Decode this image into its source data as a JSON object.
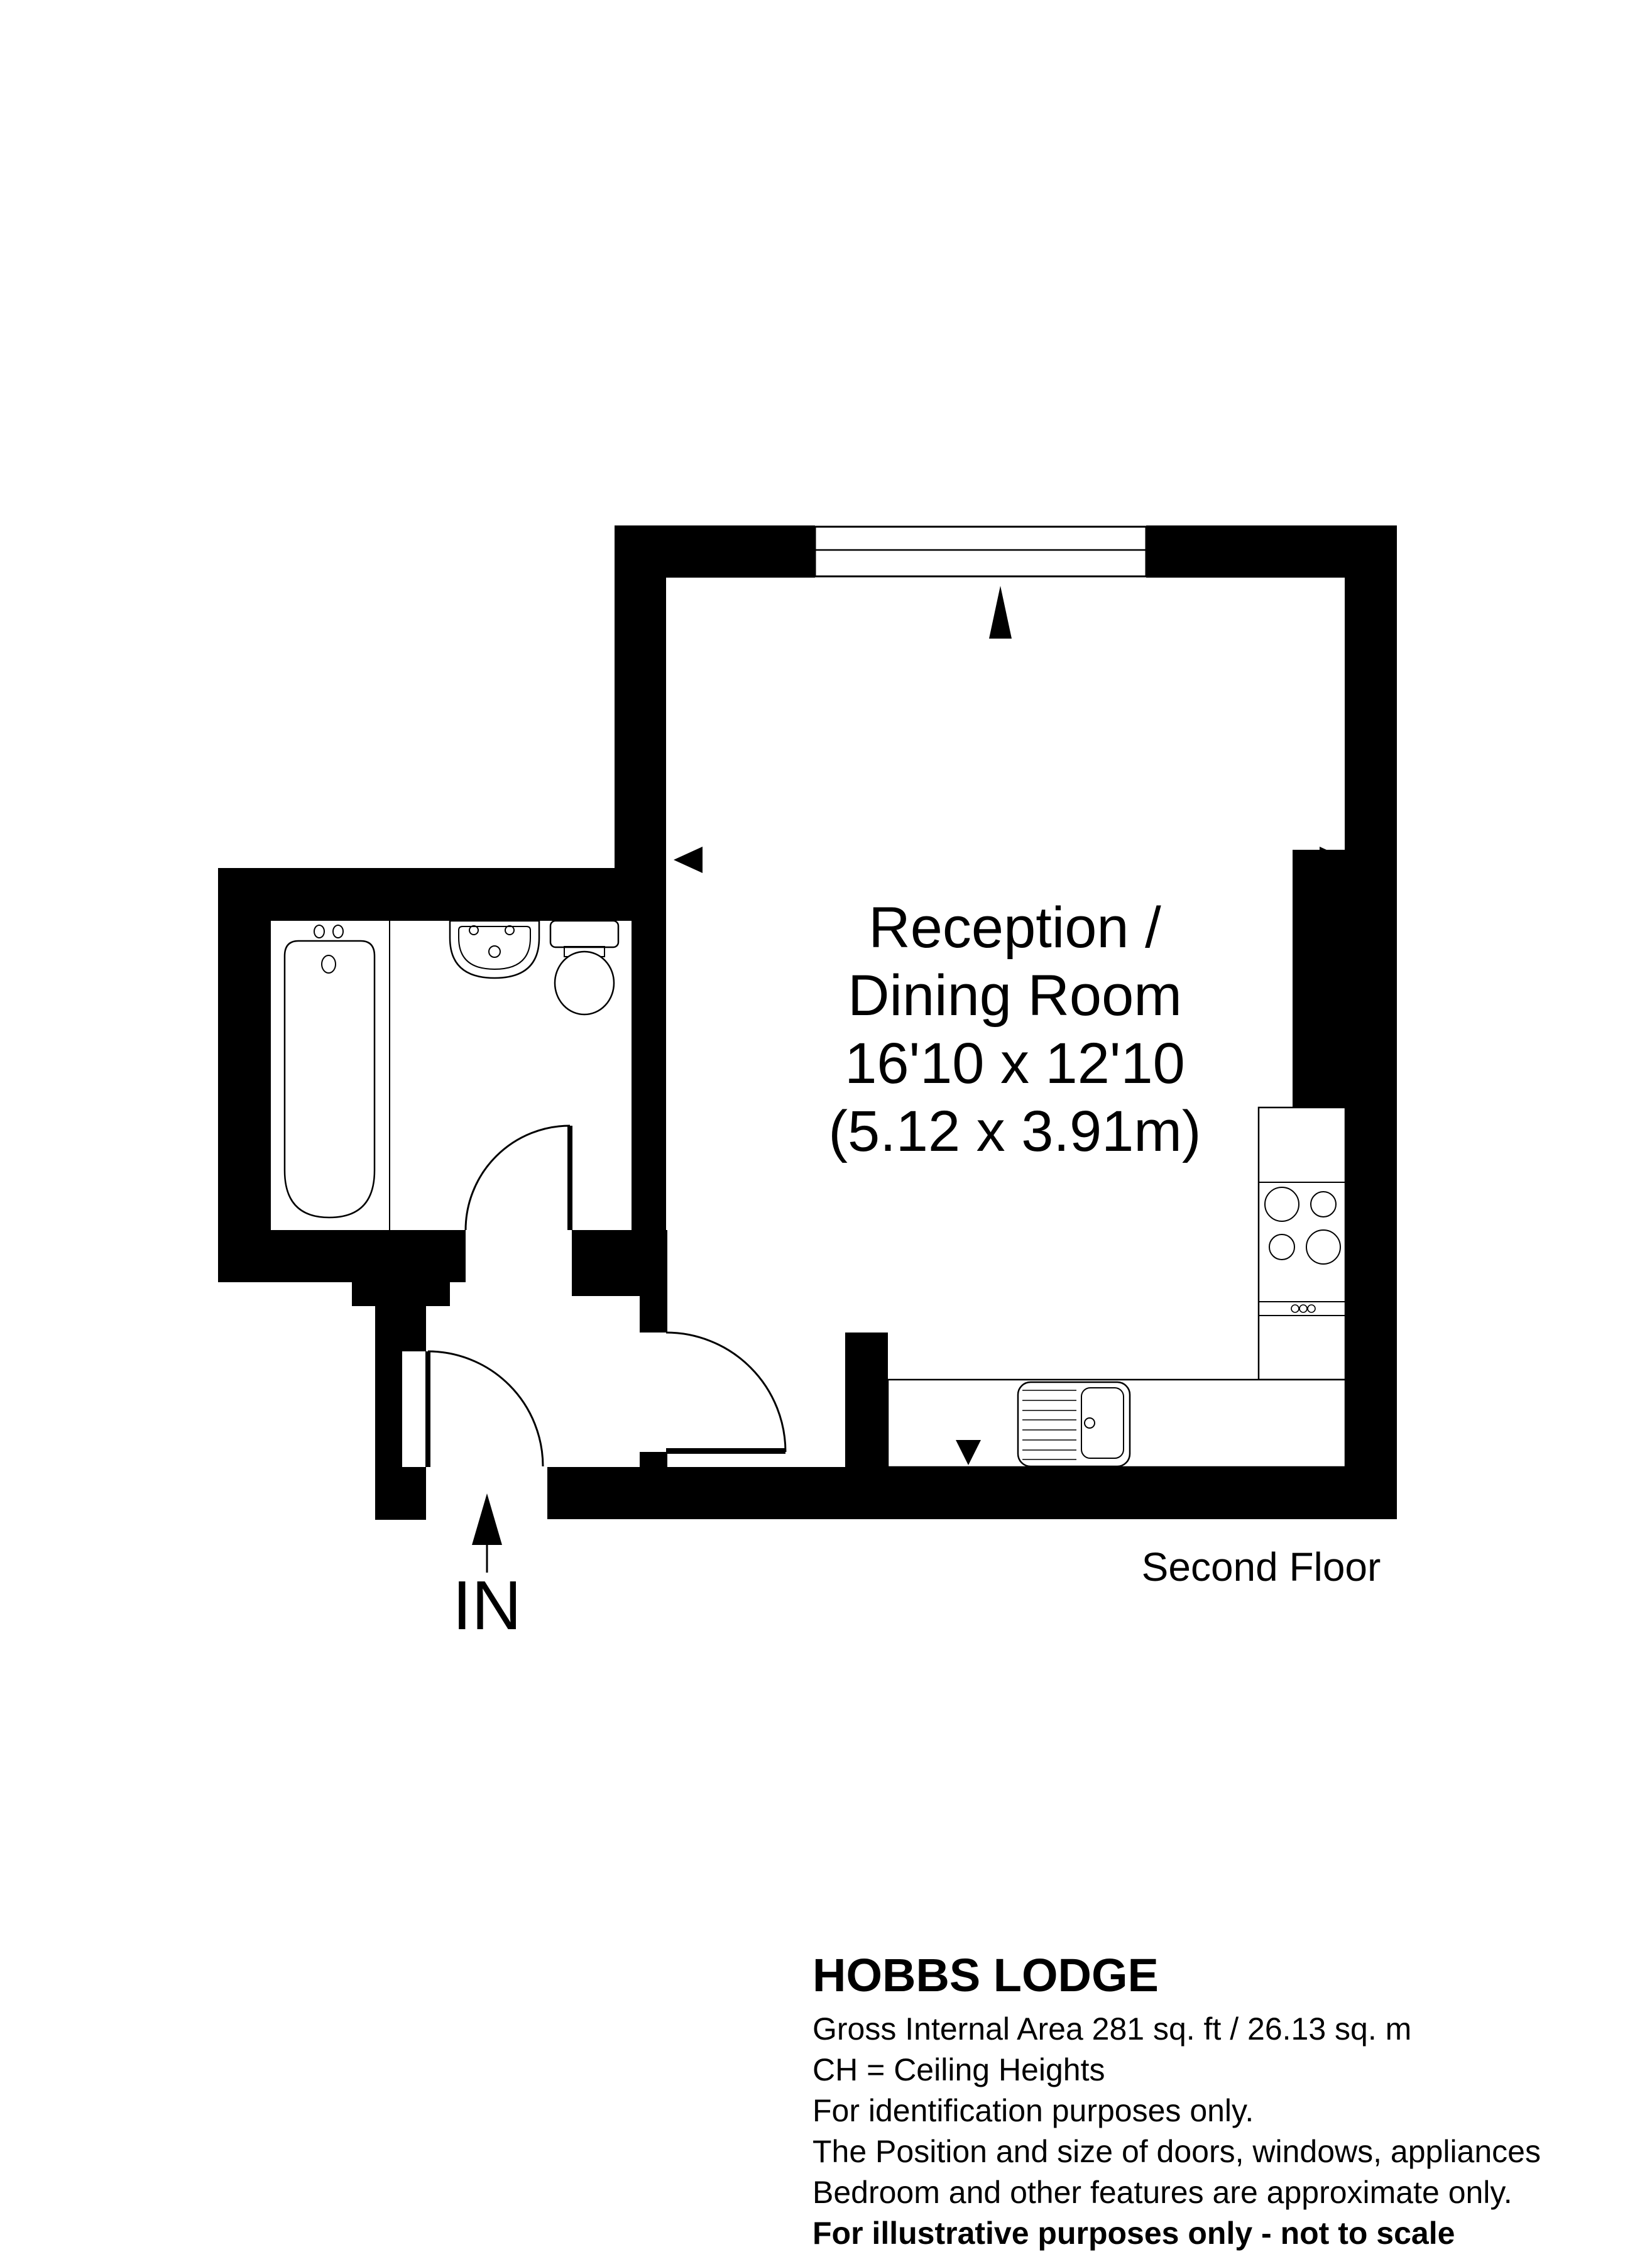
{
  "floorplan": {
    "room_label": {
      "lines": [
        "Reception /",
        "Dining Room",
        "16'10 x 12'10",
        "(5.12 x 3.91m)"
      ]
    },
    "floor_label": "Second Floor",
    "entrance_label": "IN"
  },
  "footer": {
    "title": "HOBBS LODGE",
    "lines": [
      "Gross Internal Area 281 sq. ft / 26.13 sq. m",
      "CH = Ceiling Heights",
      "For identification purposes only.",
      "The Position and size of doors, windows, appliances",
      "Bedroom and other features are approximate only."
    ],
    "disclaimer": "For illustrative purposes only - not to scale"
  },
  "colors": {
    "background": "#ffffff",
    "walls": "#000000",
    "lines": "#000000"
  }
}
